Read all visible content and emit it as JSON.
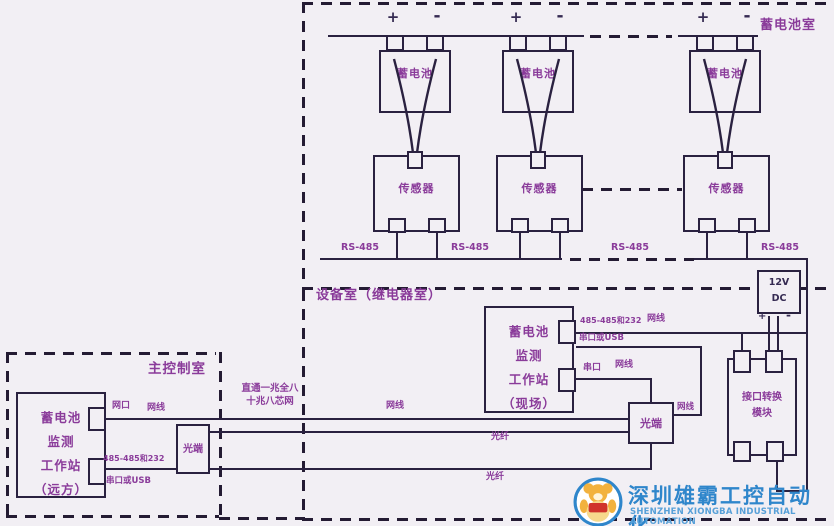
{
  "battery_room": {
    "room_label": "蓄电池室",
    "battery_label": "蓄电池",
    "sensor_label": "传感器",
    "plus": "+",
    "minus": "-"
  },
  "equipment_room": {
    "room_label": "设备室（继电器室）",
    "workstation": [
      "蓄电池",
      "监测",
      "工作站",
      "（现场）"
    ],
    "power": [
      "12V",
      "DC"
    ],
    "power_plus": "+",
    "power_minus": "-",
    "module": [
      "接口转换",
      "模块"
    ],
    "fiber_converter_label": "光端"
  },
  "control_room": {
    "room_label": "主控制室",
    "workstation": [
      "蓄电池",
      "监测",
      "工作站",
      "（远方）"
    ],
    "fiber_converter_label": "光端",
    "net_port": "网口"
  },
  "labels": {
    "rs485_bus": "RS-485",
    "rs485_232": "485-485和232",
    "serial_usb": "串口或USB",
    "serial": "串口",
    "net_cable": "网线",
    "fiber": "光纤"
  },
  "corridor": {
    "note": [
      "直通一兆全八",
      "十兆八芯网"
    ]
  },
  "watermark": {
    "company_cn": "深圳雄霸工控自动化",
    "company_en": "SHENZHEN XIONGBA INDUSTRIAL AUTOMATION"
  },
  "colors": {
    "line": "#2a2140",
    "text_purple": "#8a3b9a",
    "watermark_blue": "#2f86cb",
    "background": "#f2eff4"
  }
}
